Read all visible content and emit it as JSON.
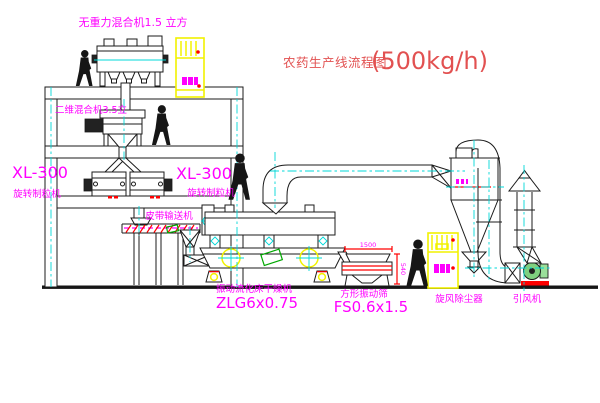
{
  "title": {
    "cn": "农药生产线流程图",
    "rate": "(500kg/h)"
  },
  "labels": {
    "mixer_top": "无重力混合机1.5 立方",
    "mixer_mid": "二维混合机3.5立",
    "granulator_left_model": "XL-300",
    "granulator_left_name": "旋转制粒机",
    "granulator_mid_model": "XL-300",
    "granulator_mid_name": "旋转制粒机",
    "conveyor": "皮带输送机",
    "dryer_name": "振动流化床干燥机",
    "dryer_model": "ZLG6x0.75",
    "sieve_name": "方形振动筛",
    "sieve_model": "FS0.6x1.5",
    "cyclone": "旋风除尘器",
    "fan": "引风机",
    "dim_length": "1500",
    "dim_height": "540"
  },
  "colors": {
    "label_magenta": "#ff00ff",
    "title_red": "#e25151",
    "centerline_cyan": "#00d8d8",
    "cabinet_yellow": "#f2f200",
    "accent_red": "#ff0000",
    "accent_green": "#00a800",
    "line_black": "#1b1b1b"
  }
}
